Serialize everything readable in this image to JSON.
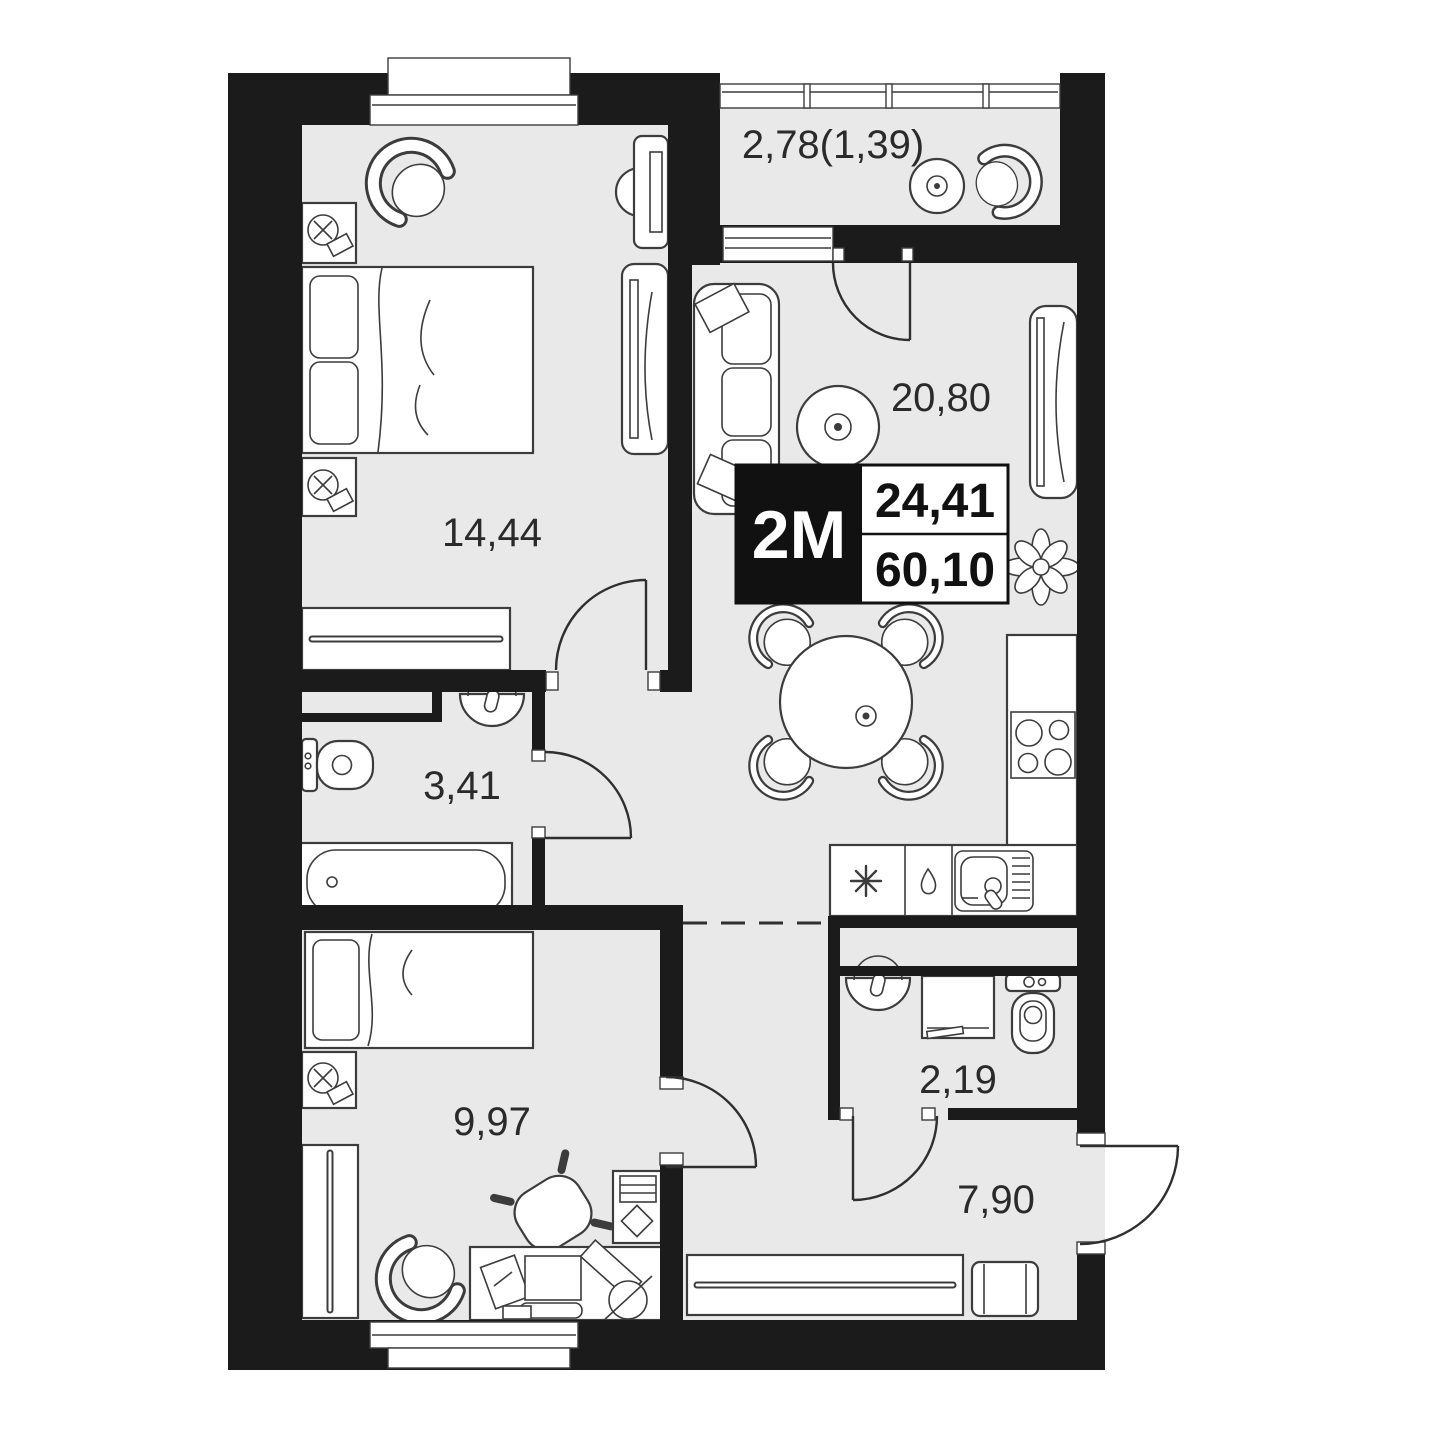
{
  "plan": {
    "badge": {
      "type": "2M",
      "rooms_area": "24,41",
      "total_area": "60,10"
    },
    "rooms": {
      "bedroom_main": {
        "area": "14,44"
      },
      "balcony": {
        "area": "2,78(1,39)"
      },
      "living_kitchen": {
        "area": "20,80"
      },
      "bathroom": {
        "area": "3,41"
      },
      "bedroom_second": {
        "area": "9,97"
      },
      "wc": {
        "area": "2,19"
      },
      "hallway": {
        "area": "7,90"
      }
    },
    "colors": {
      "wall": "#1b1b1b",
      "floor": "#e9e9e9",
      "line": "#3c3c3c",
      "text": "#2a2a2a"
    },
    "icons": {
      "fridge": "eight-spoke-asterisk",
      "dishwasher": "water-drop",
      "sink": "basin-with-faucet",
      "hob": "four-burners"
    }
  }
}
